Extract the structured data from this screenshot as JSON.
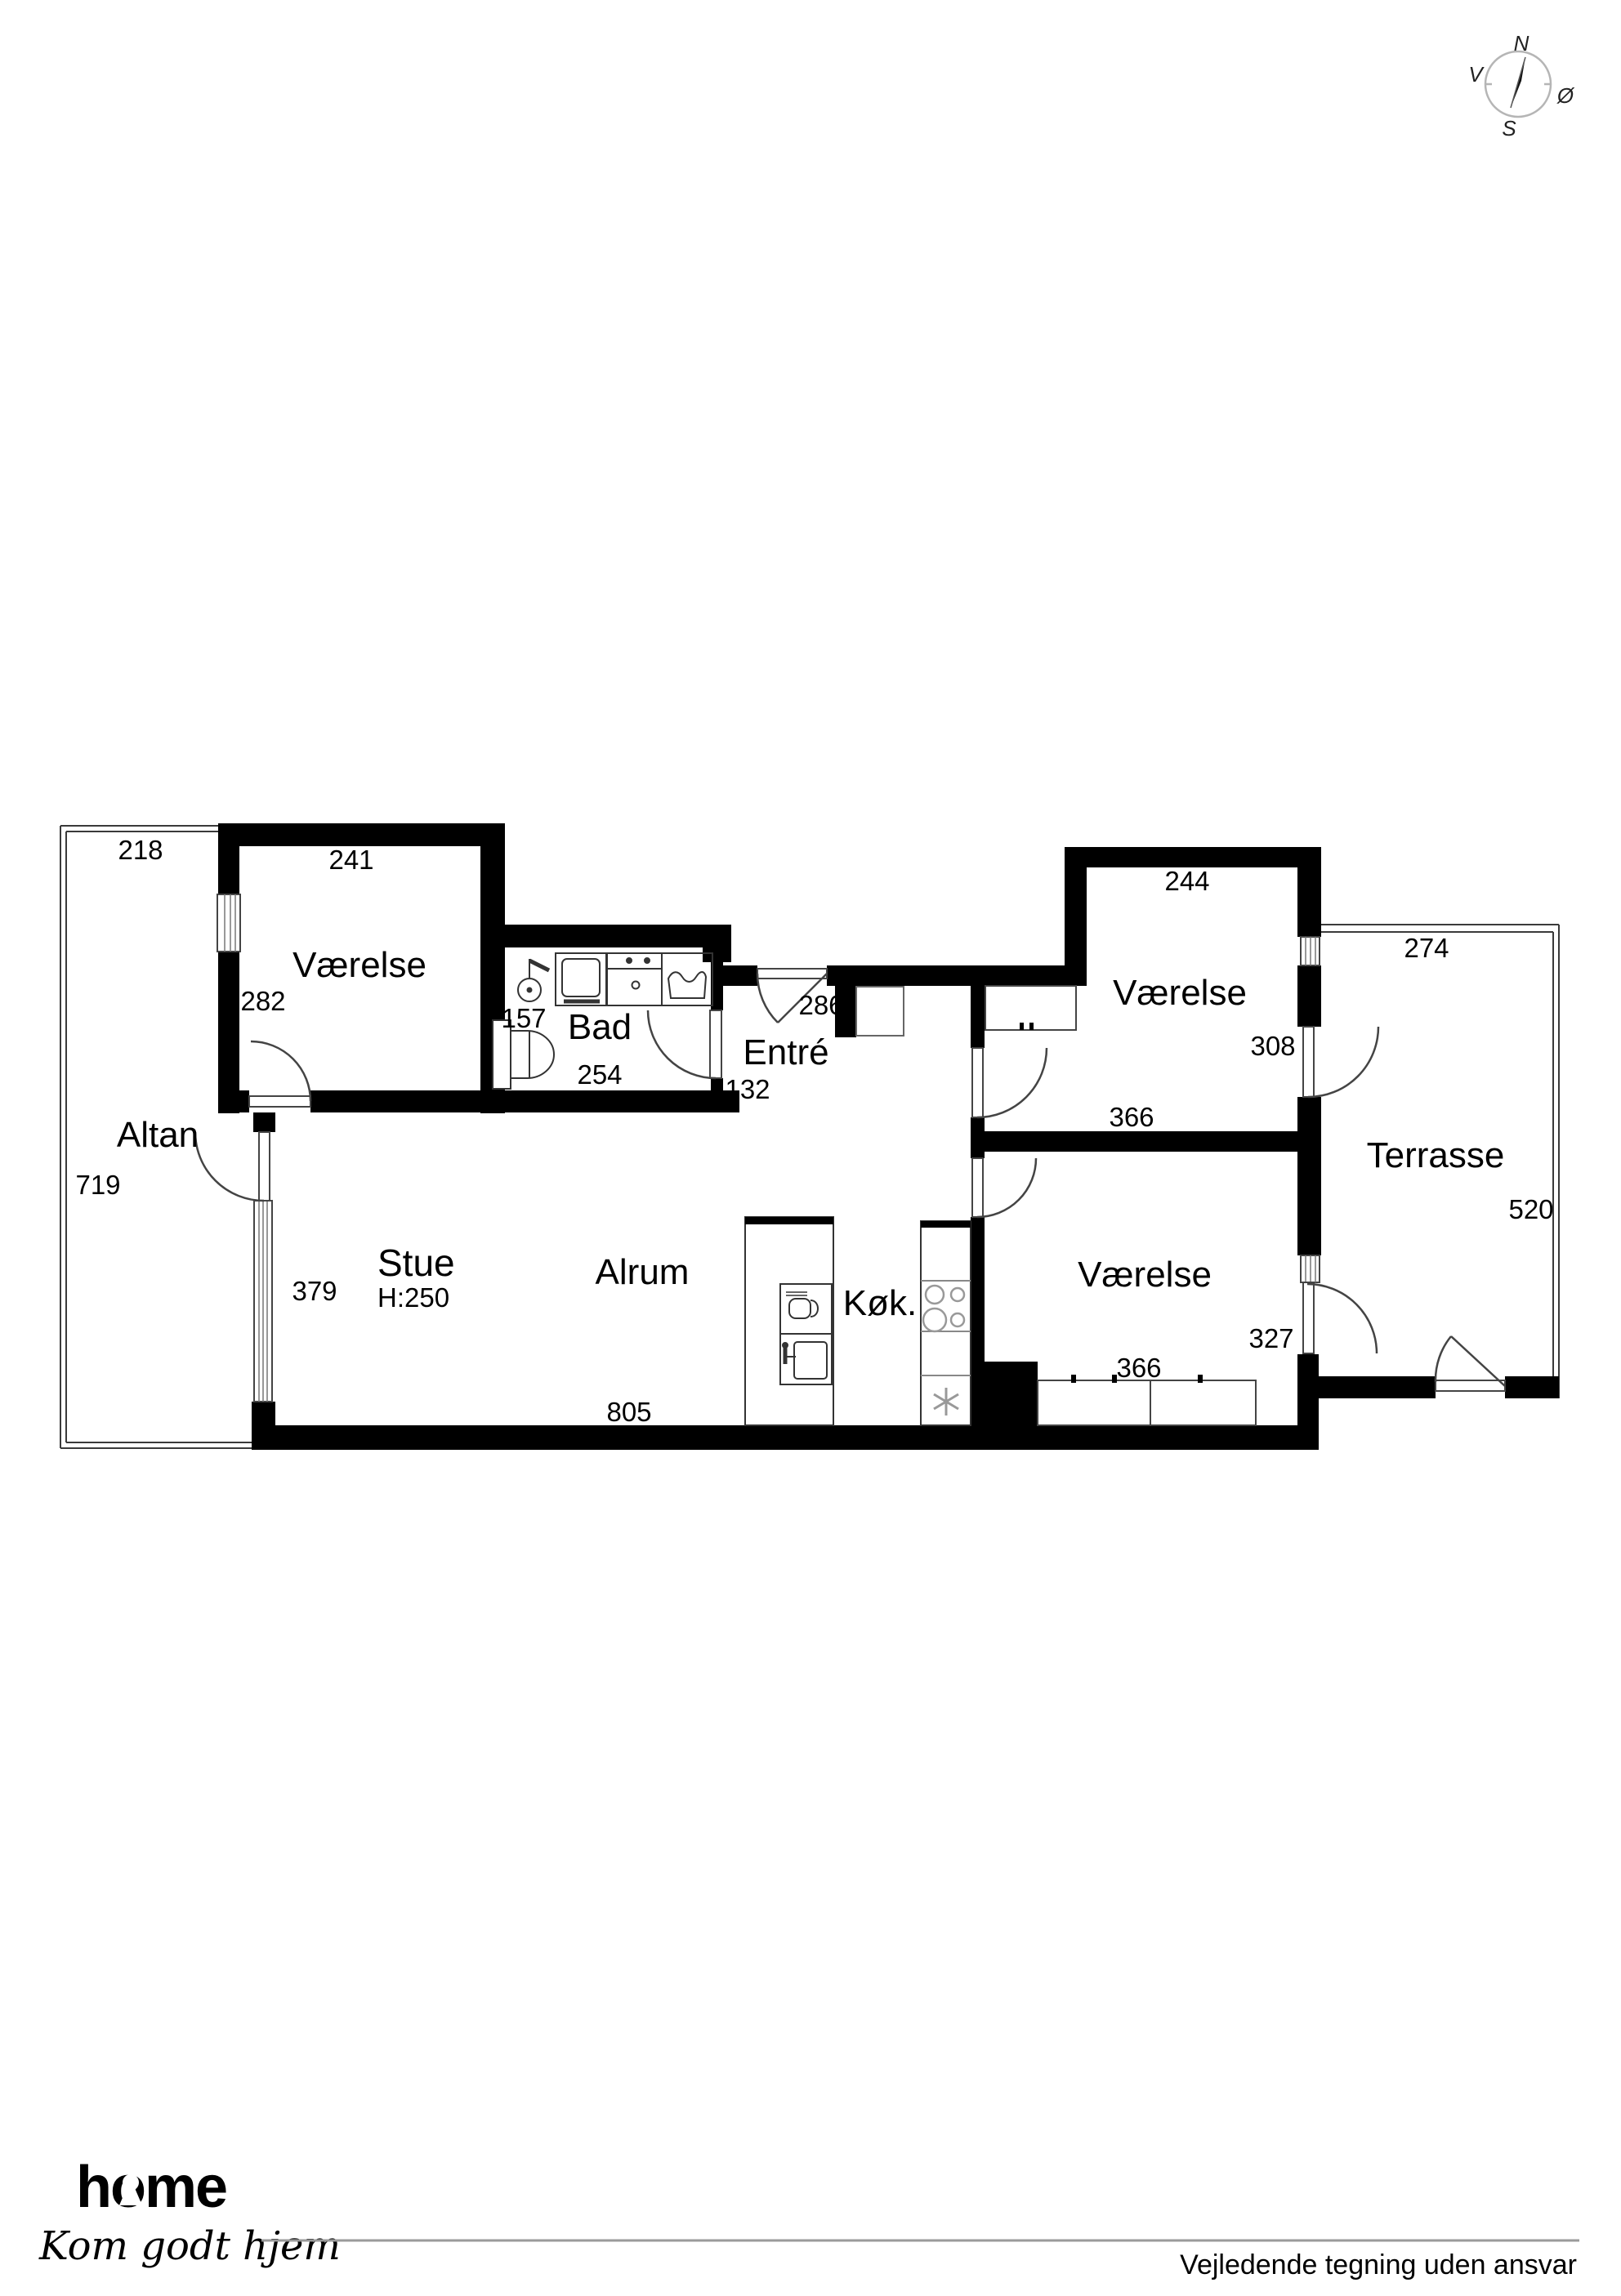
{
  "compass": {
    "n": "N",
    "s": "S",
    "v": "V",
    "oe": "Ø"
  },
  "rooms": {
    "altan": "Altan",
    "vaerelse": "Værelse",
    "bad": "Bad",
    "entre": "Entré",
    "stue": "Stue",
    "stue_ceiling": "H:250",
    "alrum": "Alrum",
    "koekken": "Køk.",
    "terrasse": "Terrasse"
  },
  "dims": {
    "altan_top": "218",
    "altan_left": "719",
    "v1_top": "241",
    "v1_left": "282",
    "bad_left": "157",
    "bad_bottom": "254",
    "entre_door": "286",
    "entre_wall": "132",
    "v2_top": "244",
    "v2_right": "308",
    "v2_bottom": "366",
    "terrasse_top": "274",
    "terrasse_right": "520",
    "stue_window": "379",
    "alrum_bottom": "805",
    "v3_right": "327",
    "v3_bottom": "366"
  },
  "footer": {
    "logo": "home",
    "tagline": "Kom godt hjem",
    "disclaimer": "Vejledende tegning uden ansvar"
  },
  "colors": {
    "wall": "#000000",
    "brand_red": "#e2001a",
    "thin_line": "#444444"
  }
}
